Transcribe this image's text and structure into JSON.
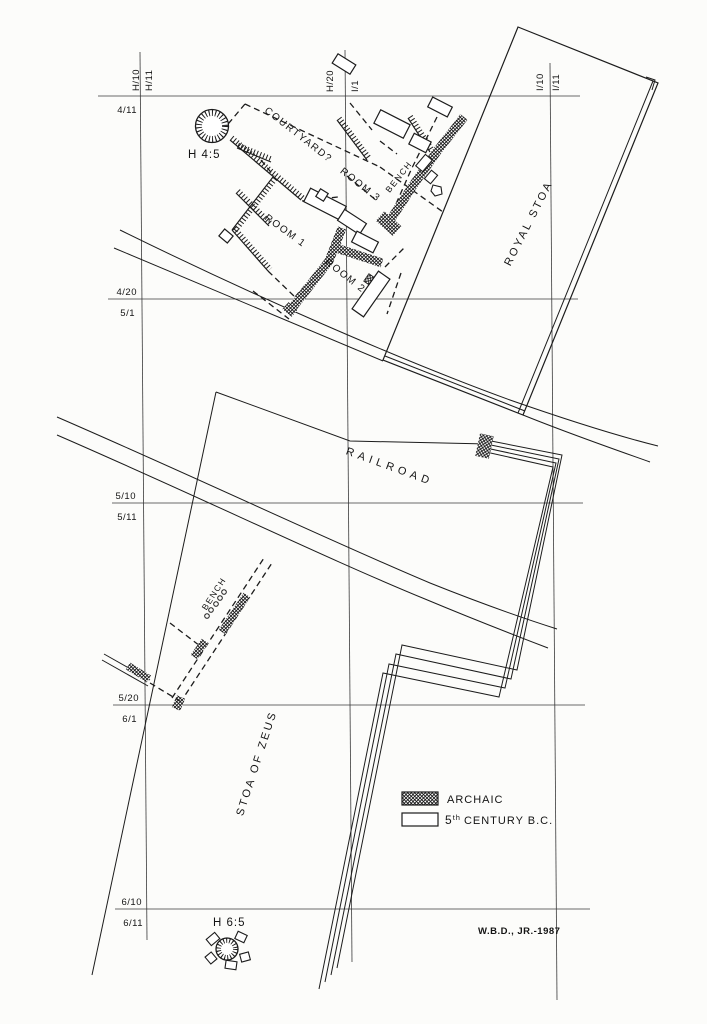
{
  "grid": {
    "h10": "H/10",
    "h11": "H/11",
    "h20": "H/20",
    "i1": "I/1",
    "i10": "I/10",
    "i11": "I/11",
    "r411": "4/11",
    "r420": "4/20",
    "r51": "5/1",
    "r510": "5/10",
    "r511": "5/11",
    "r520": "5/20",
    "r61": "6/1",
    "r610": "6/10",
    "r611": "6/11"
  },
  "labels": {
    "courtyard": "COURTYARD?",
    "room1": "ROOM 1",
    "room2": "ROOM 2",
    "room3": "ROOM 3",
    "bench_upper": "BENCH",
    "bench_lower": "BENCH",
    "royal_stoa": "ROYAL STOA",
    "railroad": "RAILROAD",
    "stoa_of_zeus": "STOA OF ZEUS",
    "well_h45": "H 4:5",
    "well_h65": "H 6:5"
  },
  "legend": {
    "archaic": "ARCHAIC",
    "fifth_base": "5",
    "fifth_sup": "th",
    "fifth_rest": "CENTURY B.C."
  },
  "credit": "W.B.D., JR.-1987",
  "colors": {
    "ink": "#1c1c1c",
    "paper": "#fcfcfa"
  }
}
